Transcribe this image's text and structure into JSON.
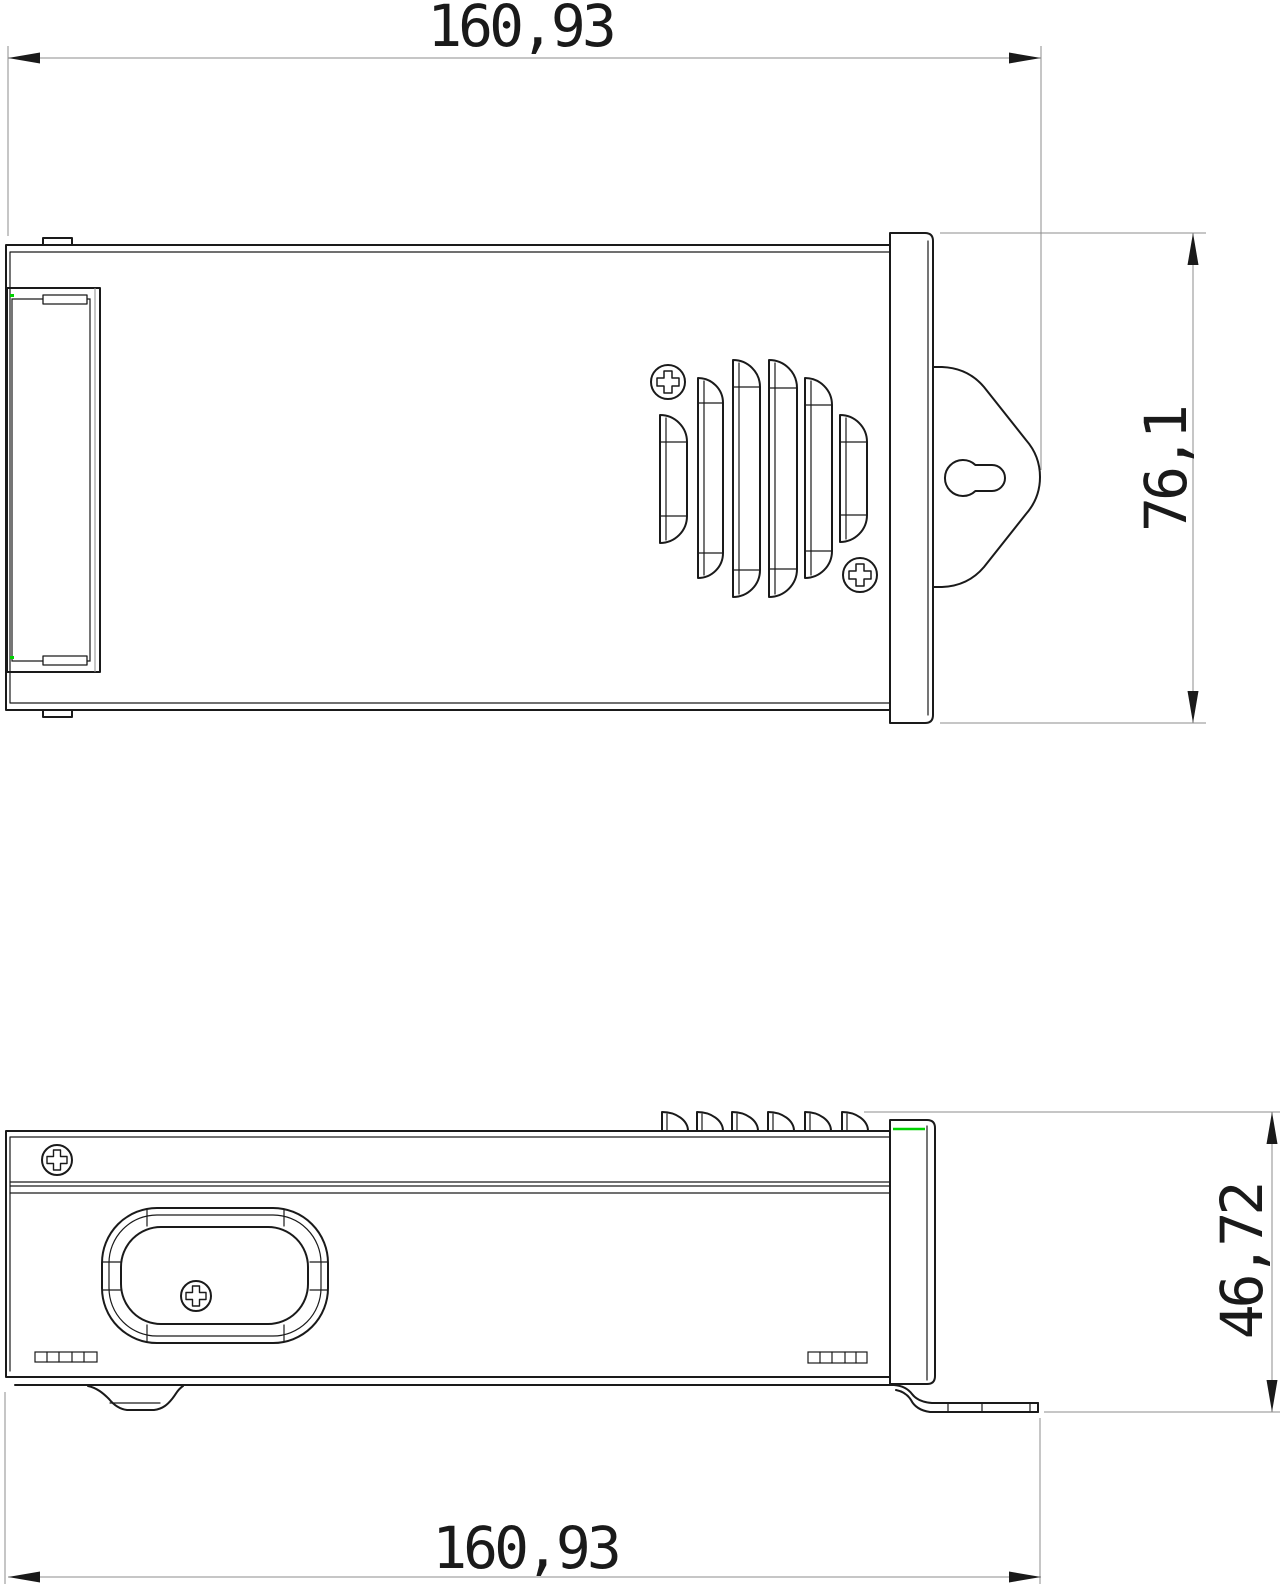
{
  "drawing": {
    "type": "2-view technical drawing of enclosure (top view and side profile view)",
    "dimensions": {
      "top_width": {
        "value": "160,93"
      },
      "front_height": {
        "value": "76,1"
      },
      "side_height": {
        "value": "46,72"
      },
      "bottom_width": {
        "value": "160,93"
      }
    },
    "features": [
      "terminal-recess",
      "vent-louvers",
      "phillips-screws",
      "mounting-tab-keyhole",
      "mounting-bracket-flange",
      "rubber-foot",
      "handle-recess"
    ],
    "colors": {
      "object_line": "#1a1a1a",
      "dimension_line": "#8c8c8c",
      "accent_green": "#00d100",
      "background": "#ffffff"
    }
  }
}
